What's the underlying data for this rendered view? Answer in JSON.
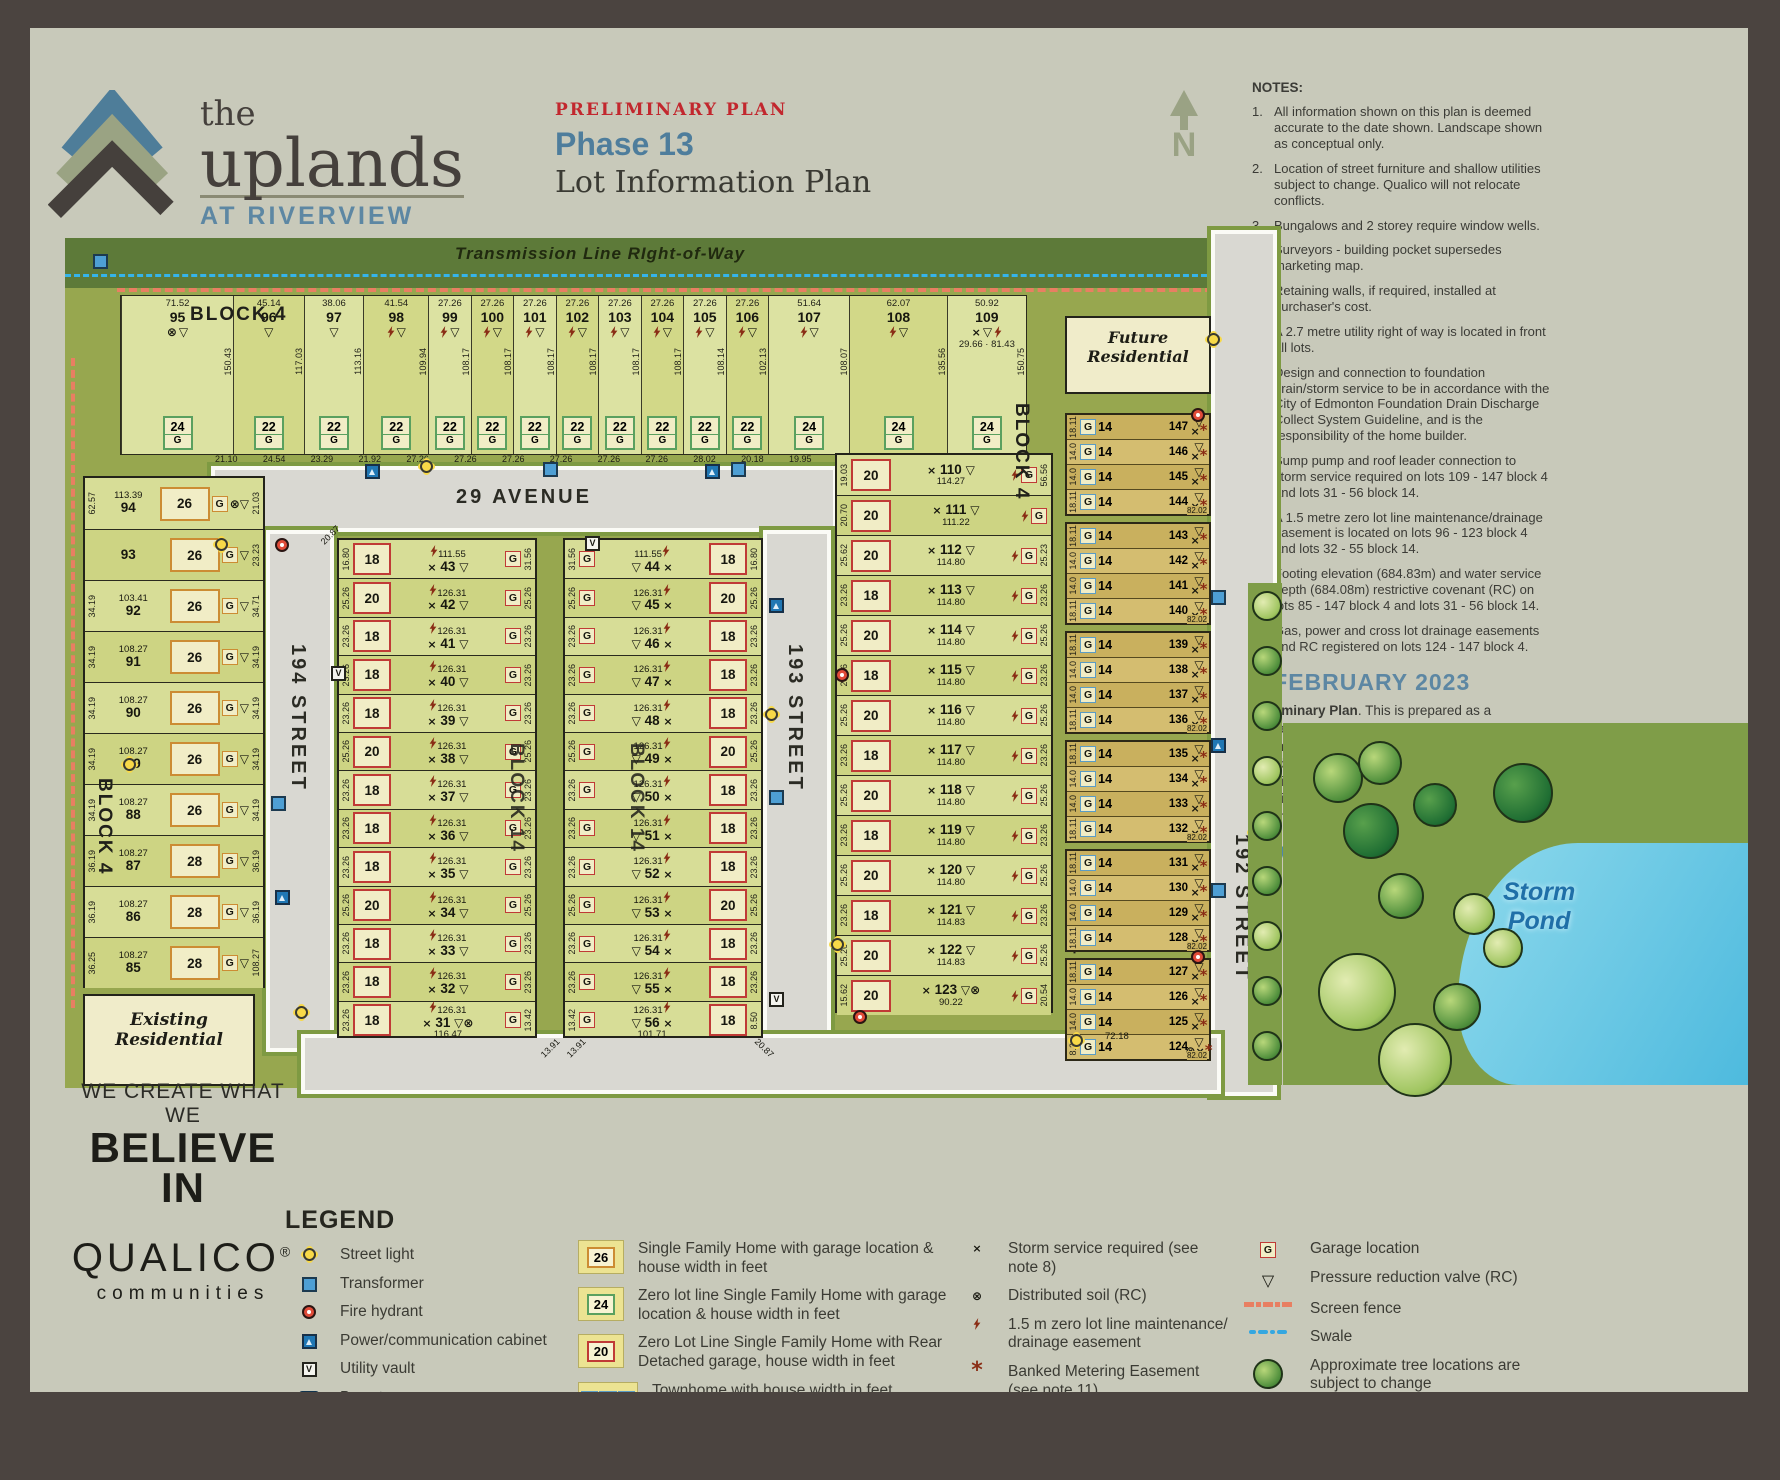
{
  "header": {
    "logo_the": "the",
    "logo_name": "uplands",
    "logo_sub": "AT RIVERVIEW",
    "plan_type": "PRELIMINARY PLAN",
    "phase": "Phase 13",
    "title": "Lot Information Plan",
    "north": "N"
  },
  "notes": {
    "heading": "NOTES:",
    "items": [
      "All information shown on this plan is deemed accurate to the date shown. Landscape shown as conceptual only.",
      "Location of street furniture and shallow utilities subject to change. Qualico will not relocate conflicts.",
      "Bungalows and 2 storey require window wells.",
      "Surveyors - building pocket supersedes marketing map.",
      "Retaining walls, if required, installed at purchaser's cost.",
      "A 2.7 metre utility right of way is located in front all lots.",
      "Design and connection to foundation drain/storm service to be in accordance with the City of Edmonton Foundation Drain Discharge Collect System Guideline, and is the responsibility of the home builder.",
      "Sump pump and roof leader connection to storm service required on lots 109 - 147 block 4 and lots 31 - 56 block 14.",
      "A 1.5 metre zero lot line maintenance/drainage easement is located on lots 96 - 123 block 4 and lots 32 - 55 block 14.",
      "Footing elevation (684.83m) and water service depth (684.08m) restrictive covenant (RC) on lots 85 - 147 block 4 and lots 31 - 56 block 14.",
      "Gas, power and cross lot drainage easements and RC registered on lots 124 - 147 block 4."
    ]
  },
  "date_block": {
    "date": "6 FEBRUARY 2023",
    "lead": "Preliminary Plan",
    "body1": ". This is prepared as a conceptual plan only and all elements are ",
    "bold": "subject to change",
    "body2": " without notification and should not be relied upon.  Please refer to the registered subdivision plan and approved engineering drawings to confirm all information. Dimensions are in feet and rounded.",
    "website": "LiveInTheUplands.com"
  },
  "map": {
    "transmission_label": "Transmission Line RIght-of-Way",
    "g_label": "G",
    "streets": {
      "avenue29": "29 AVENUE",
      "street194": "194 STREET",
      "street193": "193 STREET",
      "street192": "192 STREET"
    },
    "labels": {
      "block4": "BLOCK 4",
      "block14": "BLOCK 14",
      "future1": "Future",
      "future2": "Residential",
      "existing1": "Existing",
      "existing2": "Residential",
      "storm1": "Storm",
      "storm2": "Pond"
    },
    "arc_dims": [
      "21.10",
      "24.54",
      "23.29",
      "21.92",
      "27.26",
      "27.26",
      "27.26",
      "27.26",
      "27.26",
      "27.26",
      "28.02",
      "20.18",
      "19.95",
      "21.78",
      "19.03",
      "20.70"
    ],
    "top_row": [
      {
        "n": "95",
        "top": "71.52",
        "w": "24",
        "marks": [
          "soil",
          "prv"
        ],
        "side": "150.43"
      },
      {
        "n": "96",
        "top": "45.14",
        "w": "22",
        "marks": [
          "prv"
        ],
        "side": "117.03"
      },
      {
        "n": "97",
        "top": "38.06",
        "w": "22",
        "marks": [
          "prv"
        ],
        "side": "113.16"
      },
      {
        "n": "98",
        "top": "41.54",
        "w": "22",
        "marks": [
          "zll",
          "prv"
        ],
        "side": "109.94"
      },
      {
        "n": "99",
        "top": "27.26",
        "w": "22",
        "marks": [
          "zll",
          "prv"
        ],
        "side": "108.17"
      },
      {
        "n": "100",
        "top": "27.26",
        "w": "22",
        "marks": [
          "zll",
          "prv"
        ],
        "side": "108.17"
      },
      {
        "n": "101",
        "top": "27.26",
        "w": "22",
        "marks": [
          "zll",
          "prv"
        ],
        "side": "108.17"
      },
      {
        "n": "102",
        "top": "27.26",
        "w": "22",
        "marks": [
          "zll",
          "prv"
        ],
        "side": "108.17"
      },
      {
        "n": "103",
        "top": "27.26",
        "w": "22",
        "marks": [
          "zll",
          "prv"
        ],
        "side": "108.17"
      },
      {
        "n": "104",
        "top": "27.26",
        "w": "22",
        "marks": [
          "zll",
          "prv"
        ],
        "side": "108.17"
      },
      {
        "n": "105",
        "top": "27.26",
        "w": "22",
        "marks": [
          "zll",
          "prv"
        ],
        "side": "108.14"
      },
      {
        "n": "106",
        "top": "27.26",
        "w": "22",
        "marks": [
          "zll",
          "prv"
        ],
        "side": "102.13"
      },
      {
        "n": "107",
        "top": "51.64",
        "w": "24",
        "marks": [
          "zll",
          "prv"
        ],
        "side": "108.07"
      },
      {
        "n": "108",
        "top": "62.07",
        "w": "24",
        "marks": [
          "zll",
          "prv"
        ],
        "side": "135.56"
      },
      {
        "n": "109",
        "top": "50.92",
        "w": "24",
        "marks": [
          "storm",
          "prv",
          "zll"
        ],
        "side": "150.75",
        "extra": "29.66 · 81.43"
      }
    ],
    "west_column": [
      {
        "n": "94",
        "len": "113.39",
        "l": "62.57",
        "r": "21.03",
        "w": "26",
        "marks": [
          "soil",
          "prv"
        ]
      },
      {
        "n": "93",
        "len": "",
        "l": "",
        "r": "23.23",
        "w": "26",
        "marks": [
          "prv"
        ]
      },
      {
        "n": "92",
        "len": "103.41",
        "l": "34.19",
        "r": "34.71",
        "w": "26",
        "marks": [
          "prv"
        ]
      },
      {
        "n": "91",
        "len": "108.27",
        "l": "34.19",
        "r": "34.19",
        "w": "26",
        "marks": [
          "prv"
        ]
      },
      {
        "n": "90",
        "len": "108.27",
        "l": "34.19",
        "r": "34.19",
        "w": "26",
        "marks": [
          "prv"
        ]
      },
      {
        "n": "89",
        "len": "108.27",
        "l": "34.19",
        "r": "34.19",
        "w": "26",
        "marks": [
          "prv"
        ]
      },
      {
        "n": "88",
        "len": "108.27",
        "l": "34.19",
        "r": "34.19",
        "w": "26",
        "marks": [
          "prv"
        ]
      },
      {
        "n": "87",
        "len": "108.27",
        "l": "36.19",
        "r": "36.19",
        "w": "28",
        "marks": [
          "prv"
        ]
      },
      {
        "n": "86",
        "len": "108.27",
        "l": "36.19",
        "r": "36.19",
        "w": "28",
        "marks": [
          "prv"
        ]
      },
      {
        "n": "85",
        "len": "108.27",
        "l": "36.25",
        "r": "108.27",
        "w": "28",
        "marks": [
          "prv"
        ]
      }
    ],
    "block14_west": [
      {
        "n": "43",
        "len": "111.55",
        "l": "16.80",
        "r": "31.56",
        "w": "18"
      },
      {
        "n": "42",
        "len": "126.31",
        "l": "25.26",
        "r": "25.26",
        "w": "20"
      },
      {
        "n": "41",
        "len": "126.31",
        "l": "23.26",
        "r": "23.26",
        "w": "18"
      },
      {
        "n": "40",
        "len": "126.31",
        "l": "23.26",
        "r": "23.26",
        "w": "18"
      },
      {
        "n": "39",
        "len": "126.31",
        "l": "23.26",
        "r": "23.26",
        "w": "18"
      },
      {
        "n": "38",
        "len": "126.31",
        "l": "25.26",
        "r": "25.26",
        "w": "20"
      },
      {
        "n": "37",
        "len": "126.31",
        "l": "23.26",
        "r": "23.26",
        "w": "18"
      },
      {
        "n": "36",
        "len": "126.31",
        "l": "23.26",
        "r": "23.26",
        "w": "18"
      },
      {
        "n": "35",
        "len": "126.31",
        "l": "23.26",
        "r": "23.26",
        "w": "18"
      },
      {
        "n": "34",
        "len": "126.31",
        "l": "25.26",
        "r": "25.26",
        "w": "20"
      },
      {
        "n": "33",
        "len": "126.31",
        "l": "23.26",
        "r": "23.26",
        "w": "18"
      },
      {
        "n": "32",
        "len": "126.31",
        "l": "23.26",
        "r": "23.26",
        "w": "18"
      },
      {
        "n": "31",
        "len": "126.31",
        "len2": "116.47",
        "l": "23.26",
        "r": "13.42",
        "w": "18",
        "soil": true
      }
    ],
    "block14_east": [
      {
        "n": "44",
        "len": "111.55",
        "l": "31.56",
        "r": "16.80",
        "w": "18"
      },
      {
        "n": "45",
        "len": "126.31",
        "l": "25.26",
        "r": "25.26",
        "w": "20"
      },
      {
        "n": "46",
        "len": "126.31",
        "l": "23.26",
        "r": "23.26",
        "w": "18"
      },
      {
        "n": "47",
        "len": "126.31",
        "l": "23.26",
        "r": "23.26",
        "w": "18"
      },
      {
        "n": "48",
        "len": "126.31",
        "l": "23.26",
        "r": "23.26",
        "w": "18"
      },
      {
        "n": "49",
        "len": "126.31",
        "l": "25.26",
        "r": "25.26",
        "w": "20"
      },
      {
        "n": "50",
        "len": "126.31",
        "l": "23.26",
        "r": "23.26",
        "w": "18"
      },
      {
        "n": "51",
        "len": "126.31",
        "l": "23.26",
        "r": "23.26",
        "w": "18"
      },
      {
        "n": "52",
        "len": "126.31",
        "l": "23.26",
        "r": "23.26",
        "w": "18"
      },
      {
        "n": "53",
        "len": "126.31",
        "l": "25.26",
        "r": "25.26",
        "w": "20"
      },
      {
        "n": "54",
        "len": "126.31",
        "l": "23.26",
        "r": "23.26",
        "w": "18"
      },
      {
        "n": "55",
        "len": "126.31",
        "l": "23.26",
        "r": "23.26",
        "w": "18"
      },
      {
        "n": "56",
        "len": "126.31",
        "len2": "101.71",
        "l": "13.42",
        "r": "8.50",
        "w": "18",
        "corner": "20.87"
      }
    ],
    "east_column": [
      {
        "n": "110",
        "len": "114.27",
        "l": "19.03",
        "r": "56.56",
        "w": "20"
      },
      {
        "n": "111",
        "len": "111.22",
        "l": "20.70",
        "r": "",
        "w": "20"
      },
      {
        "n": "112",
        "len": "114.80",
        "l": "25.62",
        "r": "25.23",
        "w": "20"
      },
      {
        "n": "113",
        "len": "114.80",
        "l": "23.26",
        "r": "23.26",
        "w": "18"
      },
      {
        "n": "114",
        "len": "114.80",
        "l": "25.26",
        "r": "25.26",
        "w": "20"
      },
      {
        "n": "115",
        "len": "114.80",
        "l": "23.26",
        "r": "23.26",
        "w": "18"
      },
      {
        "n": "116",
        "len": "114.80",
        "l": "25.26",
        "r": "25.26",
        "w": "20"
      },
      {
        "n": "117",
        "len": "114.80",
        "l": "23.26",
        "r": "23.26",
        "w": "18"
      },
      {
        "n": "118",
        "len": "114.80",
        "l": "25.26",
        "r": "25.26",
        "w": "20"
      },
      {
        "n": "119",
        "len": "114.80",
        "l": "23.26",
        "r": "23.26",
        "w": "18"
      },
      {
        "n": "120",
        "len": "114.80",
        "l": "25.26",
        "r": "25.26",
        "w": "20"
      },
      {
        "n": "121",
        "len": "114.83",
        "l": "23.26",
        "r": "23.26",
        "w": "18"
      },
      {
        "n": "122",
        "len": "114.83",
        "l": "25.26",
        "r": "25.26",
        "w": "20"
      },
      {
        "n": "123",
        "len": "90.22",
        "l": "15.62",
        "r": "20.54",
        "w": "20",
        "soil": true
      }
    ],
    "townhome_unit_width": "14",
    "townhomes": [
      {
        "len": "82.02",
        "lots": [
          {
            "n": "147",
            "s": "18.11"
          },
          {
            "n": "146",
            "s": "14.0"
          },
          {
            "n": "145",
            "s": "14.0"
          },
          {
            "n": "144",
            "s": "18.11"
          }
        ]
      },
      {
        "len": "82.02",
        "lots": [
          {
            "n": "143",
            "s": "18.11"
          },
          {
            "n": "142",
            "s": "14.0"
          },
          {
            "n": "141",
            "s": "14.0"
          },
          {
            "n": "140",
            "s": "18.11"
          }
        ]
      },
      {
        "len": "82.02",
        "lots": [
          {
            "n": "139",
            "s": "18.11"
          },
          {
            "n": "138",
            "s": "14.0"
          },
          {
            "n": "137",
            "s": "14.0"
          },
          {
            "n": "136",
            "s": "18.11"
          }
        ]
      },
      {
        "len": "82.02",
        "lots": [
          {
            "n": "135",
            "s": "18.11"
          },
          {
            "n": "134",
            "s": "14.0"
          },
          {
            "n": "133",
            "s": "14.0"
          },
          {
            "n": "132",
            "s": "18.11"
          }
        ]
      },
      {
        "len": "82.02",
        "lots": [
          {
            "n": "131",
            "s": "18.11"
          },
          {
            "n": "130",
            "s": "14.0"
          },
          {
            "n": "129",
            "s": "14.0"
          },
          {
            "n": "128",
            "s": "18.11"
          }
        ]
      },
      {
        "len": "82.02",
        "lots": [
          {
            "n": "127",
            "s": "18.11"
          },
          {
            "n": "126",
            "s": "14.0"
          },
          {
            "n": "125",
            "s": "14.0"
          },
          {
            "n": "124",
            "s": "8.27",
            "soil": true
          }
        ]
      }
    ],
    "townhome_bottom_dim": "72.18",
    "bottom_dims": {
      "d1": "13.91",
      "d2": "13.91",
      "d3": "20.87",
      "d4": "20.87",
      "d5": "15.62"
    }
  },
  "legend": {
    "heading": "LEGEND",
    "col1": [
      {
        "icon": "street-light",
        "label": "Street light"
      },
      {
        "icon": "transformer",
        "label": "Transformer"
      },
      {
        "icon": "fire-hydrant",
        "label": "Fire hydrant"
      },
      {
        "icon": "power-cabinet",
        "label": "Power/communication cabinet"
      },
      {
        "icon": "utility-vault",
        "label": "Utility vault"
      },
      {
        "icon": "bus-stop",
        "label": "Bus stop"
      }
    ],
    "col2": [
      {
        "swatch": "26",
        "outline": "#cc8c33",
        "label": "Single Family Home with garage location & house width in feet"
      },
      {
        "swatch": "24",
        "outline": "#5aa05f",
        "label": "Zero lot line Single Family Home with garage location & house width in feet"
      },
      {
        "swatch": "20",
        "outline": "#c03a36",
        "label": "Zero Lot Line Single Family Home with Rear Detached garage, house width in feet"
      },
      {
        "swatch": "20 20 20",
        "outline": "#5a9cc5",
        "label": "Townhome with house width in feet",
        "townhome": true
      }
    ],
    "col3": [
      {
        "sym": "storm",
        "label": "Storm service required (see note 8)"
      },
      {
        "sym": "soil",
        "label": "Distributed soil (RC)"
      },
      {
        "sym": "zll",
        "label": "1.5 m zero lot line maintenance/ drainage easement"
      },
      {
        "sym": "bme",
        "label": "Banked Metering Easement (see note 11)"
      }
    ],
    "col4": [
      {
        "sym": "garage",
        "label": "Garage location"
      },
      {
        "sym": "prv",
        "label": "Pressure reduction valve (RC)"
      },
      {
        "sym": "fence",
        "label": "Screen fence"
      },
      {
        "sym": "swale",
        "label": "Swale"
      },
      {
        "sym": "tree",
        "label": "Approximate tree locations are subject to change"
      }
    ]
  },
  "footer": {
    "tagline1": "WE CREATE WHAT WE",
    "tagline2": "BELIEVE IN",
    "brand": "QUALICO",
    "reg": "®",
    "brand_sub": "communities"
  }
}
